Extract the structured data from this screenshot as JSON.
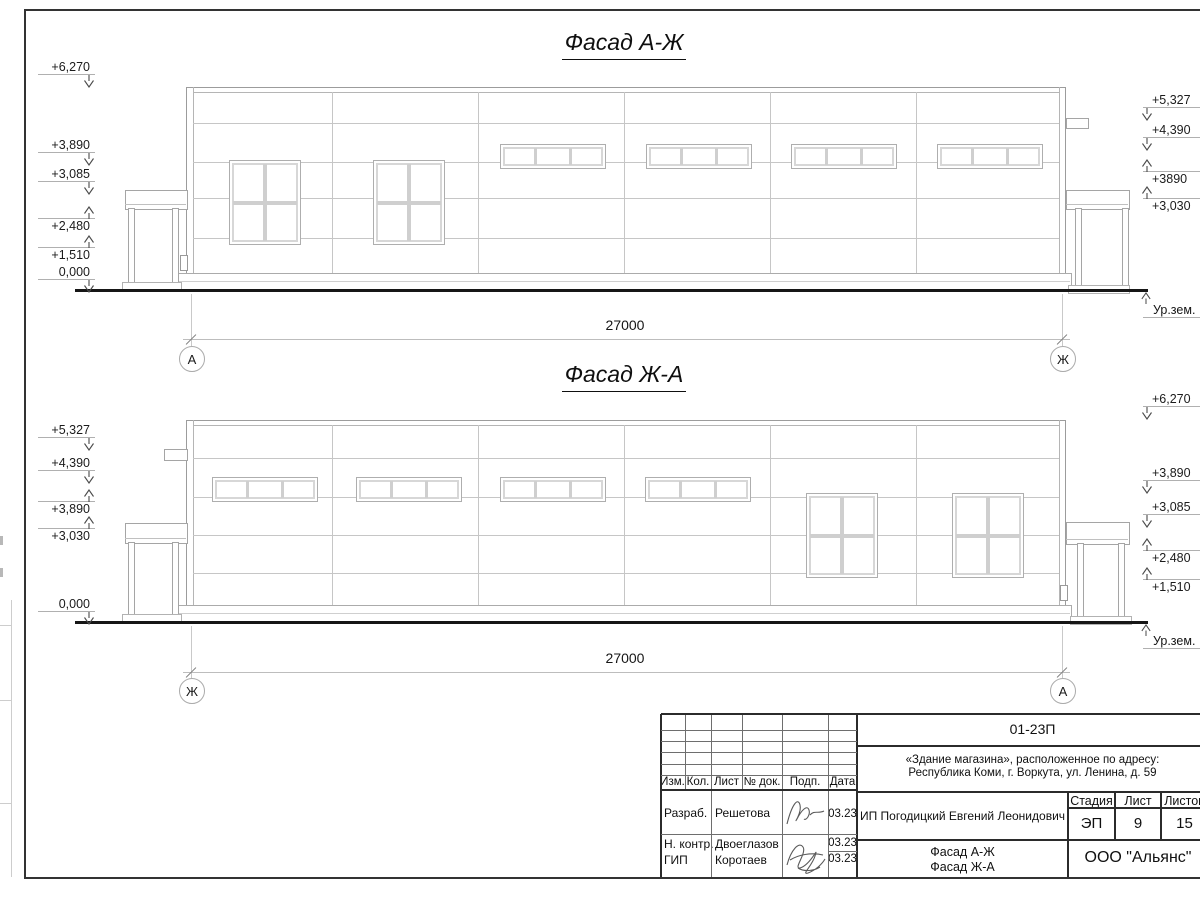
{
  "drawing": {
    "facade1": {
      "title": "Фасад А-Ж",
      "dimension": "27000",
      "axis_left": "А",
      "axis_right": "Ж",
      "ground_label": "Ур.зем.",
      "marks_left": [
        {
          "label": "+6,270",
          "arrow": "down"
        },
        {
          "label": "+3,890",
          "arrow": "down"
        },
        {
          "label": "+3,085",
          "arrow": "down"
        },
        {
          "label": "+2,480",
          "arrow": "up"
        },
        {
          "label": "+1,510",
          "arrow": "up"
        },
        {
          "label": "0,000",
          "arrow": "down"
        }
      ],
      "marks_right": [
        {
          "label": "+5,327",
          "arrow": "down"
        },
        {
          "label": "+4,390",
          "arrow": "down"
        },
        {
          "label": "+3890",
          "arrow": "up"
        },
        {
          "label": "+3,030",
          "arrow": "up"
        }
      ]
    },
    "facade2": {
      "title": "Фасад Ж-А",
      "dimension": "27000",
      "axis_left": "Ж",
      "axis_right": "А",
      "ground_label": "Ур.зем.",
      "marks_left": [
        {
          "label": "+5,327",
          "arrow": "down"
        },
        {
          "label": "+4,390",
          "arrow": "down"
        },
        {
          "label": "+3,890",
          "arrow": "up"
        },
        {
          "label": "+3,030",
          "arrow": "up"
        },
        {
          "label": "0,000",
          "arrow": "down"
        }
      ],
      "marks_right": [
        {
          "label": "+6,270",
          "arrow": "down"
        },
        {
          "label": "+3,890",
          "arrow": "down"
        },
        {
          "label": "+3,085",
          "arrow": "down"
        },
        {
          "label": "+2,480",
          "arrow": "up"
        },
        {
          "label": "+1,510",
          "arrow": "up"
        }
      ]
    }
  },
  "title_block": {
    "code": "01-23П",
    "project_line1": "«Здание магазина», расположенное по адресу:",
    "project_line2": "Республика Коми, г. Воркута, ул. Ленина, д. 59",
    "col_headers": {
      "izm": "Изм.",
      "kol": "Кол.",
      "list": "Лист",
      "ndok": "№ док.",
      "podp": "Подп.",
      "data": "Дата"
    },
    "signers": [
      {
        "role": "Разраб.",
        "name": "Решетова",
        "date": "03.23"
      },
      {
        "role": "Н. контр.",
        "name": "Двоеглазов",
        "date": "03.23"
      },
      {
        "role": "ГИП",
        "name": "Коротаев",
        "date": "03.23"
      }
    ],
    "client": "ИП Погодицкий Евгений Леонидович",
    "stage_header": "Стадия",
    "sheet_header": "Лист",
    "sheets_header": "Листов",
    "stage": "ЭП",
    "sheet_number": "9",
    "sheets_total": "15",
    "drawing_title_line1": "Фасад А-Ж",
    "drawing_title_line2": "Фасад Ж-А",
    "organization": "ООО \"Альянс\""
  }
}
